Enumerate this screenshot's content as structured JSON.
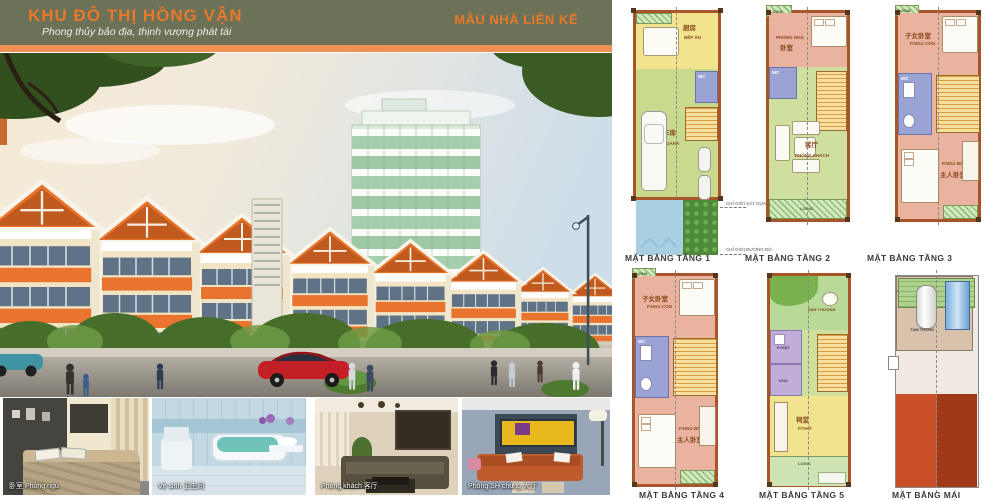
{
  "palette": {
    "header_bg": "#6b7258",
    "accent_orange": "#e8792a",
    "bar_orange": "#ef9055",
    "wall_brown": "#a8552a",
    "plan_pink": "#eab3a0",
    "plan_green": "#cfdf9e",
    "plan_yellow": "#f2e38e",
    "plan_wc_blue": "#9aa3d4",
    "yard_blue": "#a9cfe3",
    "roof_red": "#c0471f"
  },
  "header": {
    "title": "KHU ĐÔ THỊ HỒNG VẬN",
    "subtitle": "Phong thủy bảo địa, thịnh vượng phát tài",
    "right_title": "MẪU NHÀ LIÊN KẾ"
  },
  "photos": [
    {
      "caption": "卧室 Phòng ngủ"
    },
    {
      "caption": "Vệ sinh 卫生间"
    },
    {
      "caption": "Phòng khách 客厅"
    },
    {
      "caption": "Phòng SH chung 大厅"
    }
  ],
  "plans": {
    "floor1": {
      "label": "MẶT BẰNG TẦNG 1",
      "kitchen_cn": "厨房",
      "kitchen_vn": "BẾP ĂN",
      "garage_cn": "车库",
      "garage_vn": "GARA",
      "wc": "WC",
      "boundary_build": "CHỈ GIỚI XÂY DỰNG",
      "boundary_red": "CHỈ GIỚI ĐƯỜNG ĐỎ"
    },
    "floor2": {
      "label": "MẶT BẰNG TẦNG 2",
      "logia_top": "LOGIA",
      "bedroom_vn": "PHÒNG NGỦ",
      "bedroom_cn": "卧室",
      "wc": "WC",
      "living_cn": "客厅",
      "living_vn": "PHÒNG KHÁCH",
      "logia_bottom": "LOGIA"
    },
    "floor3": {
      "label": "MẶT BẰNG TẦNG 3",
      "logia": "LOGIA",
      "child_cn": "子女卧室",
      "child_vn": "P.NGỦ CON",
      "wc": "WC",
      "master_vn": "P.NGỦ BỐ MẸ",
      "master_cn": "主人卧室"
    },
    "floor4": {
      "label": "MẶT BẰNG TẦNG 4",
      "logia": "LOGIA",
      "child_cn": "子女卧室",
      "child_vn": "P.NGỦ CON",
      "wc": "WC",
      "master_vn": "P.NGỦ BỐ MẸ",
      "master_cn": "主人卧室"
    },
    "floor5": {
      "label": "MẶT BẰNG TẦNG 5",
      "terrace": "SÂN THƯỢNG",
      "laundry": "P.GIẶT",
      "storage": "KHO",
      "worship_cn": "祠堂",
      "worship_vn": "P.THỜ",
      "logia": "LOGIA"
    },
    "roof": {
      "label": "MẶT BẰNG MÁI",
      "tum": "TUM THANG"
    }
  }
}
